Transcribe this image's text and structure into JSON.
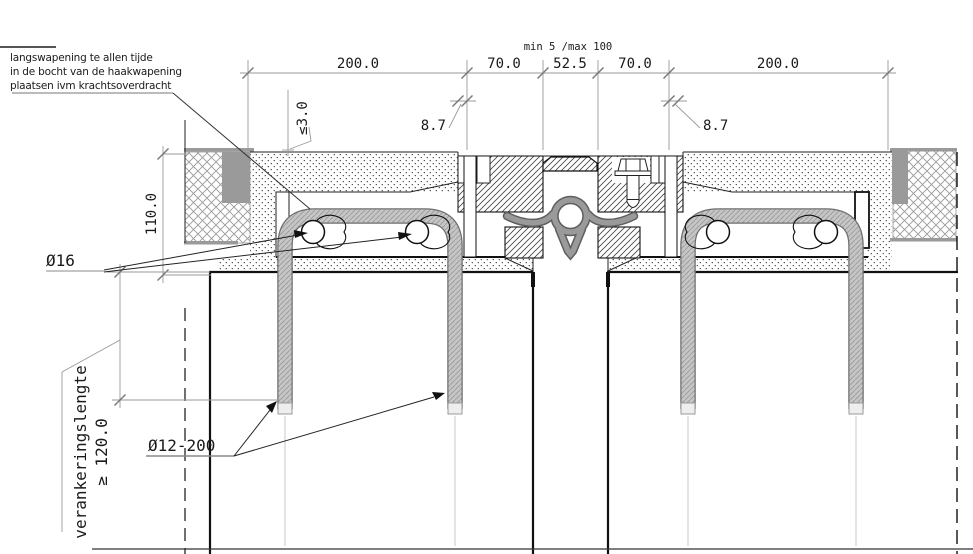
{
  "drawing": {
    "notes": {
      "reinforcement_note": [
        "langswapening te allen tijde",
        "in de bocht van de haakwapening",
        "plaatsen ivm krachtsoverdracht"
      ]
    },
    "dimensions": {
      "top_row": [
        "200.0",
        "70.0",
        "52.5",
        "70.0",
        "200.0"
      ],
      "gap_range": "min 5 /max 100",
      "surface_offset": "≤3.0",
      "edge_left": "8.7",
      "edge_right": "8.7",
      "depth": "110.0",
      "anchorage_label": "verankeringslengte",
      "anchorage_value": "≥ 120.0",
      "main_bar": "Ø16",
      "hook_bar": "Ø12-200"
    },
    "colors": {
      "rubber_seal": "#8f8f8f",
      "joint_filler": "#9a9a9a",
      "rebar_fill": "#c6c6c6"
    }
  }
}
